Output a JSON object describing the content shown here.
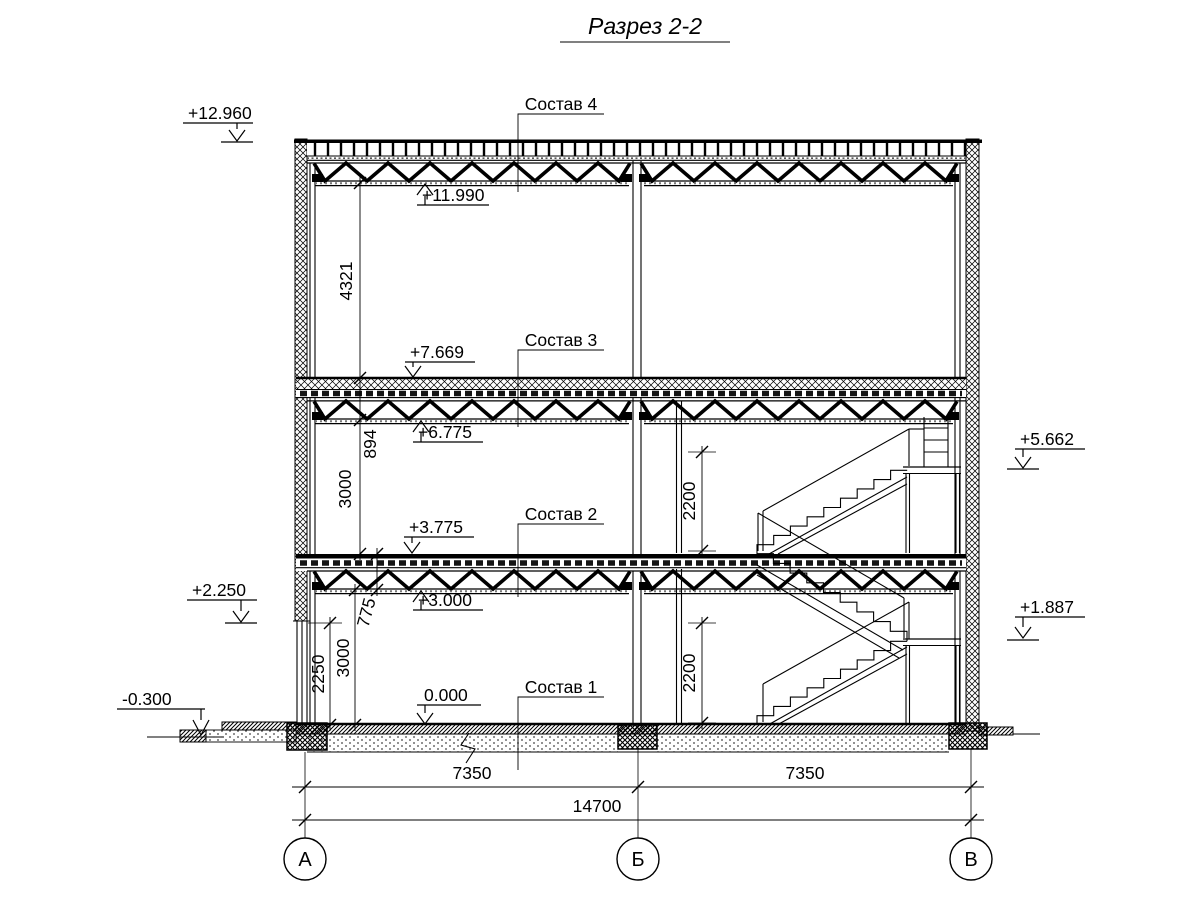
{
  "title": "Разрез 2-2",
  "axes": {
    "bubble_a": "А",
    "bubble_b": "Б",
    "bubble_v": "В"
  },
  "dimensions": {
    "horizontal": {
      "bay_left": "7350",
      "bay_right": "7350",
      "total": "14700"
    },
    "vertical": {
      "roof_space": "4321",
      "truss3_zone": "894",
      "storey_upper": "3000",
      "truss2_zone": "775",
      "wall_panel": "2250",
      "storey_lower": "3000",
      "stair_clearance_upper": "2200",
      "stair_clearance_lower": "2200"
    }
  },
  "elevations": {
    "roof_parapet": "+12.960",
    "roof_truss_bottom": "+11.990",
    "floor3_top": "+7.669",
    "truss3_bottom": "+6.775",
    "landing_upper": "+5.662",
    "floor2_top": "+3.775",
    "truss2_bottom": "+3.000",
    "panel_top": "+2.250",
    "landing_lower": "+1.887",
    "floor1_top": "0.000",
    "ground": "-0.300"
  },
  "composition_labels": {
    "c4": "Состав 4",
    "c3": "Состав 3",
    "c2": "Состав 2",
    "c1": "Состав 1"
  },
  "colors": {
    "ink": "#000000",
    "paper": "#ffffff"
  }
}
